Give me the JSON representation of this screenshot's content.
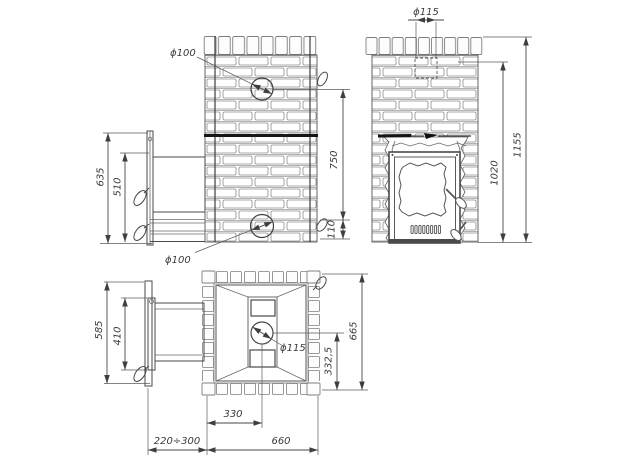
{
  "drawing": {
    "background": "#ffffff",
    "ink": "#4a4a4a",
    "title": "brick-sauna-stove-three-view-dimension-drawing",
    "views": {
      "side": {
        "name": "side elevation with fuel tunnel",
        "labels": {
          "phi_top": "ϕ100",
          "phi_bottom": "ϕ100",
          "h635": "635",
          "h510": "510",
          "h750": "750",
          "h110": "110"
        }
      },
      "front": {
        "name": "front elevation with stove door",
        "labels": {
          "phi_chimney": "ϕ115",
          "h1155": "1155",
          "h1020": "1020"
        }
      },
      "plan": {
        "name": "top plan view",
        "labels": {
          "d585": "585",
          "d410": "410",
          "d665": "665",
          "d332_5": "332,5",
          "d330": "330",
          "d_tunnel": "220÷300",
          "d660": "660",
          "phi_circle": "ϕ115"
        }
      }
    }
  }
}
